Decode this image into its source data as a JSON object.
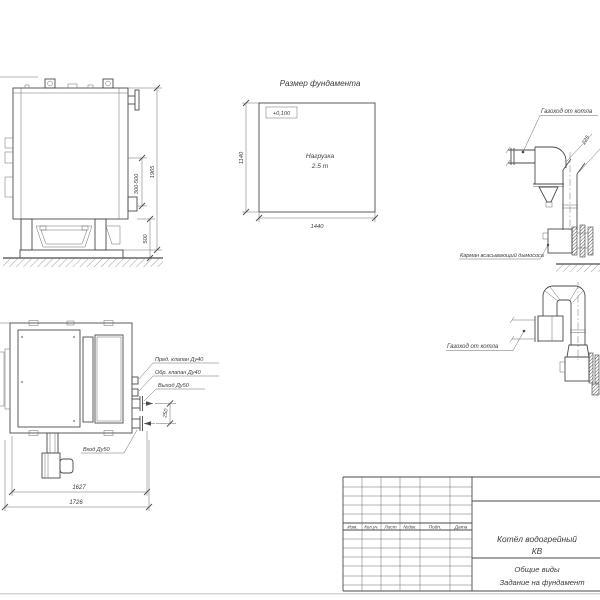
{
  "colors": {
    "line": "#4a4a4a",
    "text": "#3b3b3b",
    "background": "#ffffff"
  },
  "side_view": {
    "dim_flue": "300-500",
    "dim_height": "1965",
    "dim_base": "500"
  },
  "foundation": {
    "title": "Размер фундамента",
    "elevation": "+0,100",
    "load1": "Нагрузка",
    "load2": "2.5 т",
    "dim_h": "1140",
    "dim_w": "1440"
  },
  "flue1": {
    "duct_label": "Газоход от котла",
    "dim": "225",
    "pocket_label": "Карман всасывающий дымососа"
  },
  "flue2": {
    "duct_label": "Газоход от котла"
  },
  "plan": {
    "safety_valve": "Пред. клапан Ду40",
    "check_valve": "Обр. клапан Ду40",
    "outlet": "Выход Ду50",
    "inlet": "Вход Ду50",
    "dim_spacing": "250",
    "dim_inner": "1627",
    "dim_outer": "1726"
  },
  "title_block": {
    "col_izm": "Изм.",
    "col_koluch": "Кол.уч.",
    "col_list": "Лист",
    "col_ndok": "№док.",
    "col_podp": "Подп.",
    "col_data": "Дата",
    "product1": "Котёл водогрейный",
    "product2": "КВ",
    "doc1": "Общие виды",
    "doc2": "Задание на фундамент"
  }
}
